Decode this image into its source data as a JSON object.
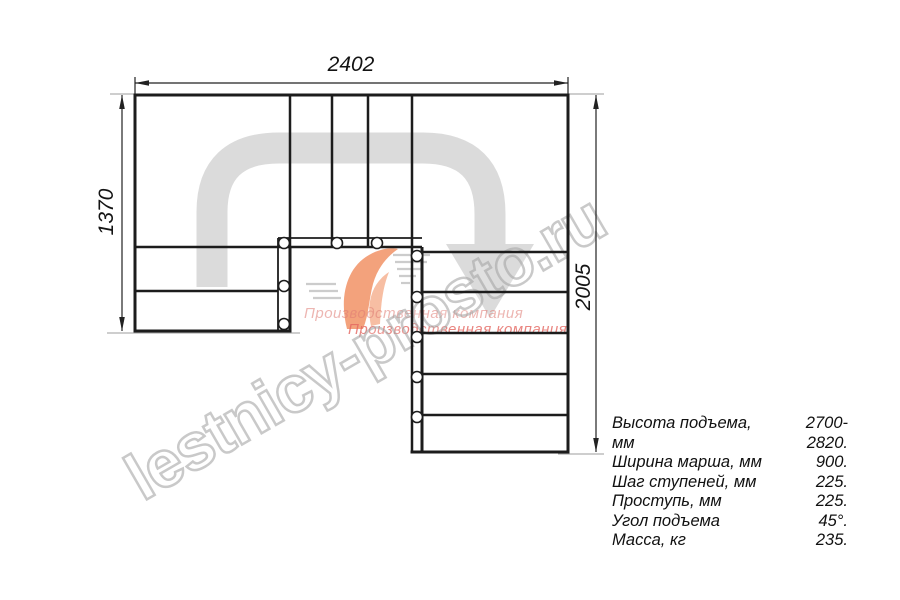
{
  "drawing": {
    "dimensions": {
      "top": "2402",
      "left": "1370",
      "right": "2005"
    }
  },
  "specs": {
    "rows": [
      {
        "label": "Высота подъема, мм",
        "value": "2700-2820."
      },
      {
        "label": "Ширина марша, мм",
        "value": "900."
      },
      {
        "label": "Шаг ступеней, мм",
        "value": "225."
      },
      {
        "label": "Проступь, мм",
        "value": "225."
      },
      {
        "label": "Угол подъема",
        "value": "45°."
      },
      {
        "label": "Масса, кг",
        "value": "235."
      }
    ]
  },
  "watermark": {
    "site": "lestnicy-prosto.ru",
    "company_line1": "Производственная компания",
    "company_line2": "Производственная компания"
  },
  "colors": {
    "line": "#1c1c1c",
    "walk_arrow": "#dbdbdb",
    "logo_orange": "#f29266",
    "watermark_gray": "#a5a5a5",
    "company_pink": "#e4766e"
  }
}
